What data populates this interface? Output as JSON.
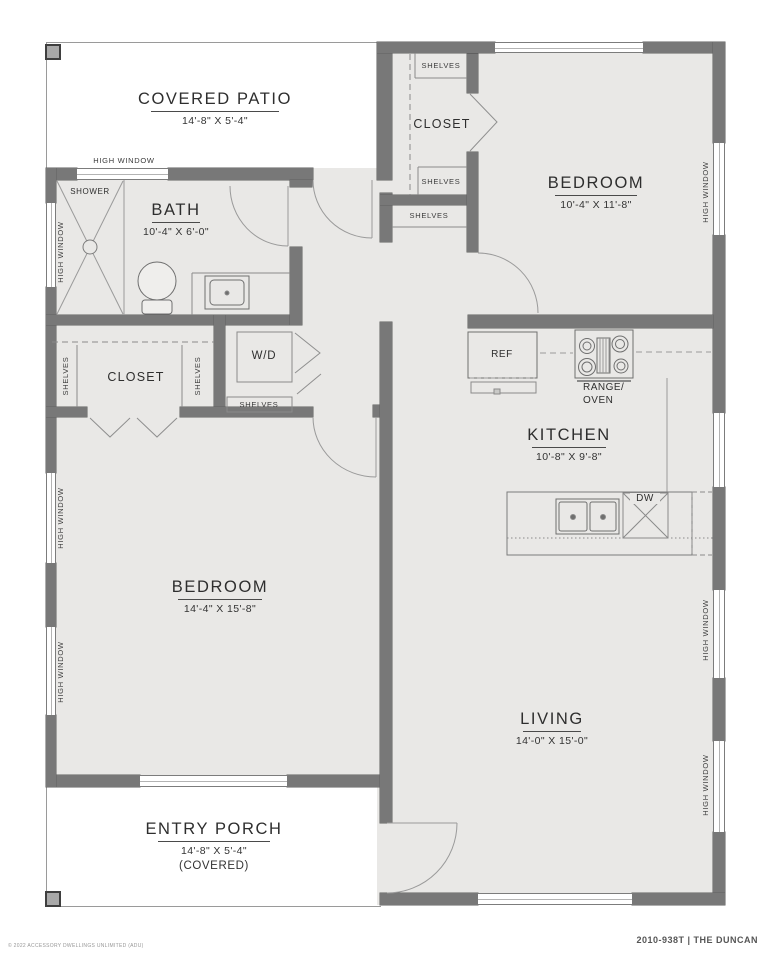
{
  "plan": {
    "title_block": {
      "plan_code": "2010-938T | THE DUNCAN",
      "copyright": "© 2022 ACCESSORY DWELLINGS UNLIMITED (ADU)"
    },
    "rooms": {
      "covered_patio": {
        "name": "COVERED PATIO",
        "dims": "14'-8\" X 5'-4\""
      },
      "bath": {
        "name": "BATH",
        "dims": "10'-4\" X 6'-0\""
      },
      "bedroom_upper": {
        "name": "BEDROOM",
        "dims": "10'-4\" X 11'-8\""
      },
      "kitchen": {
        "name": "KITCHEN",
        "dims": "10'-8\" X 9'-8\""
      },
      "bedroom_lower": {
        "name": "BEDROOM",
        "dims": "14'-4\" X 15'-8\""
      },
      "living": {
        "name": "LIVING",
        "dims": "14'-0\" X 15'-0\""
      },
      "entry_porch": {
        "name": "ENTRY PORCH",
        "dims": "14'-8\" X 5'-4\"",
        "note": "(COVERED)"
      },
      "closet_upper": {
        "name": "CLOSET"
      },
      "closet_lower": {
        "name": "CLOSET"
      }
    },
    "fixtures": {
      "shower": "SHOWER",
      "washer_dryer": "W/D",
      "refrigerator": "REF",
      "range_line1": "RANGE/",
      "range_line2": "OVEN",
      "dishwasher": "DW"
    },
    "annotations": {
      "shelves": "SHELVES",
      "high_window": "HIGH WINDOW"
    },
    "colors": {
      "wall": "#787878",
      "room_fill": "#e9e8e6",
      "outline": "#606060",
      "page": "#ffffff"
    }
  }
}
